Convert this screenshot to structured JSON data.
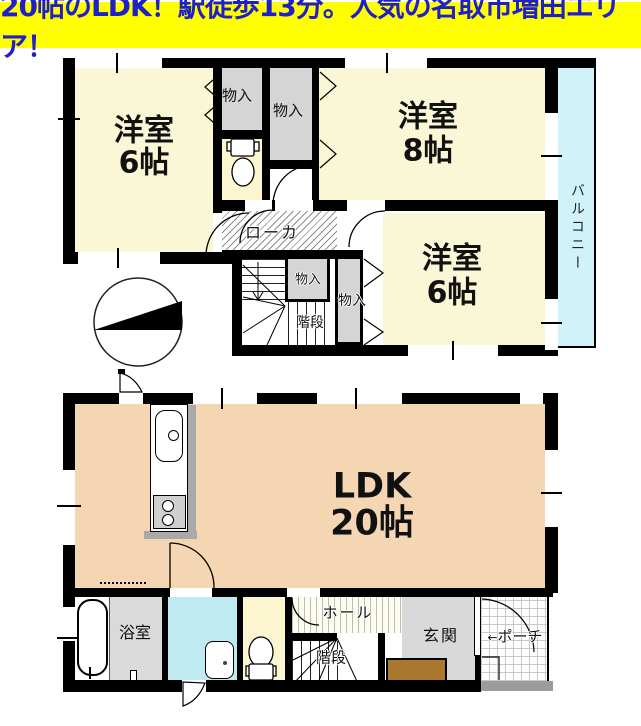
{
  "banner": {
    "text": "20帖のLDK！駅徒歩13分。人気の名取市増田エリア！",
    "bg_color": "#FFFF00",
    "text_color": "#2020C8"
  },
  "colors": {
    "room_yellow": "#FAF7D6",
    "toilet_yellow": "#FBF6D0",
    "ldk_peach": "#F4D7B2",
    "closet_gray": "#D5D5D5",
    "entrance_gray": "#D9D9D9",
    "bath_gray": "#DADADA",
    "balcony_cyan": "#D0F2F8",
    "washroom_cyan": "#BFEAF2",
    "cabinet_brown": "#A8792F",
    "porch_strip_gray": "#9C9C9C",
    "wall": "#000000"
  },
  "second_floor": {
    "room_tl": {
      "name": "洋室",
      "size": "6帖"
    },
    "room_tr": {
      "name": "洋室",
      "size": "8帖"
    },
    "room_br": {
      "name": "洋室",
      "size": "6帖"
    },
    "closet_a": "物入",
    "closet_b": "物入",
    "closet_c": "物入",
    "closet_d": "物入",
    "corridor": "ローカ",
    "stairs": "階段",
    "balcony": "バルコニー"
  },
  "first_floor": {
    "ldk": {
      "name": "LDK",
      "size": "20帖"
    },
    "bathroom": "浴室",
    "hall": "ホール",
    "stairs": "階段",
    "entrance": "玄関",
    "porch": "ポーチ",
    "porch_arrow": "←"
  },
  "icons": {
    "compass": "compass-north-wedge",
    "toilet": "toilet-icon",
    "kitchen": "kitchen-sink-stove",
    "bathtub": "bathtub-icon",
    "washbasin": "washbasin-icon"
  }
}
